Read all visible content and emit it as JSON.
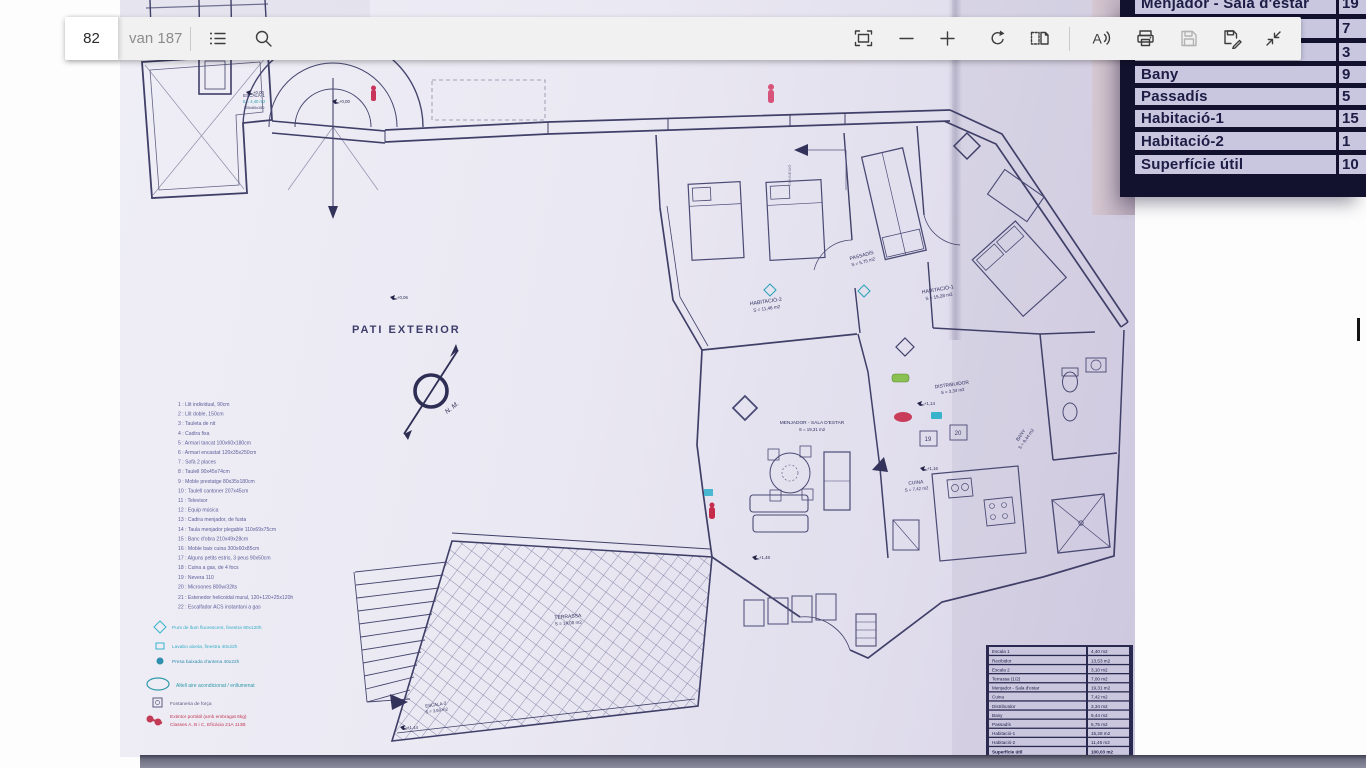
{
  "toolbar": {
    "page_input_value": "82",
    "of_label": "van 187",
    "buttons": [
      "contents",
      "search",
      "fit-to-page",
      "zoom-out",
      "zoom-in",
      "rotate",
      "page-layout",
      "read-aloud",
      "print",
      "save",
      "save-as",
      "exit-fullscreen"
    ]
  },
  "inset_table": {
    "rows": [
      {
        "label": "Menjador - Sala d'estar",
        "value": "19"
      },
      {
        "label": "",
        "value": "7"
      },
      {
        "label": "",
        "value": "3"
      },
      {
        "label": "Bany",
        "value": "9"
      },
      {
        "label": "Passadís",
        "value": "5"
      },
      {
        "label": "Habitació-1",
        "value": "15"
      },
      {
        "label": "Habitació-2",
        "value": "1"
      },
      {
        "label": "Superfície útil",
        "value": "10"
      }
    ]
  },
  "plan": {
    "pati_label": "PATI EXTERIOR",
    "compass_label": "N. M.",
    "connexio_label": "CONNEXIÓ",
    "kitchen_tags": [
      "19",
      "20"
    ],
    "levels": [
      "+0,00",
      "+0,06",
      "+1,14",
      "+1,16",
      "+1,44",
      "+1,48"
    ],
    "rooms": [
      {
        "name": "ESCALA-1",
        "area": "S = 4,40 m2",
        "extra": "100x60x150"
      },
      {
        "name": "HABITACIÓ-2",
        "area": "S = 11,46 m2"
      },
      {
        "name": "PASSADÍS",
        "area": "S = 5,75 m2"
      },
      {
        "name": "HABITACIÓ-1",
        "area": "S = 15,28 m2"
      },
      {
        "name": "DISTRIBUIDOR",
        "area": "S = 3,34 m2"
      },
      {
        "name": "MENJADOR - SALA D'ESTAR",
        "area": "S = 19,31 m2"
      },
      {
        "name": "BANY",
        "area": "S = 9,44 m2"
      },
      {
        "name": "CUINA",
        "area": "S = 7,42 m2"
      },
      {
        "name": "TERRASSA",
        "area": "S = 14,00 m2"
      },
      {
        "name": "ESCALA-2",
        "area": "S = 3,60 m2"
      }
    ],
    "legend": {
      "items": [
        "1 : Llit individual, 90cm",
        "2 : Llit doble, 150cm",
        "3 : Tauleta de nit",
        "4 : Cadira fixa",
        "5 : Armari tancat 100x60x180cm",
        "6 : Armari encastat 120x35x250cm",
        "7 : Sofà 2 places",
        "8 : Taulell 90x45x74cm",
        "9 : Moble prestatge 80x35x180cm",
        "10 : Taulell cantoner 207x45cm",
        "11 : Televisor",
        "12 : Equip música",
        "13 : Cadira menjador, de fusta",
        "14 : Taula menjador plegable 110x69x75cm",
        "15 : Banc d'obra 210x49x28cm",
        "16 : Moble baix cuina 300x60x85cm",
        "17 : Alguns petits estris, 3 peus 90x50cm",
        "18 : Cuina a gas, de 4 focs",
        "19 : Nevera 110",
        "20 : Microones 800w/32lts",
        "21 : Estenedor helicoidal mural, 120+120+25x120h",
        "22 : Escalfador ACS instantani a gas"
      ],
      "notes_cyan": [
        "Punt de llum fluorescent, finestra 90x120h",
        "Lavabo aixeta, finestra 40x22h",
        "Presa baixada d'antena 40x22h"
      ],
      "note_teal": "Altell aire acondicionat / enllumenat",
      "note_fontaneria": "Fontaneria de força",
      "note_red_line1": "Extintor portàtil (amb embragat 6kg)",
      "note_red_line2": "Classes A, B i C, Eficàcia 21A 113B"
    },
    "area_table": {
      "rows": [
        {
          "label": "Escala 1",
          "value": "4,40 m2"
        },
        {
          "label": "Recibidor",
          "value": "13,53 m2"
        },
        {
          "label": "Escala 2",
          "value": "3,10 m2"
        },
        {
          "label": "Terrassa (1/2)",
          "value": "7,00 m2"
        },
        {
          "label": "Menjador - Sala d'estar",
          "value": "19,31 m2"
        },
        {
          "label": "Cuina",
          "value": "7,42 m2"
        },
        {
          "label": "Distribuïdor",
          "value": "3,34 m2"
        },
        {
          "label": "Bany",
          "value": "9,44 m2"
        },
        {
          "label": "Passadís",
          "value": "5,75 m2"
        },
        {
          "label": "Habitació-1",
          "value": "15,28 m2"
        },
        {
          "label": "Habitació-2",
          "value": "11,46 m2"
        },
        {
          "label": "Superfície útil",
          "value": "100,03 m2"
        }
      ]
    },
    "colors": {
      "annotation_red": "#c62b4a",
      "annotation_cyan": "#39b3cc",
      "annotation_green": "#8abf52",
      "annotation_teal": "#2fa3b8",
      "legend_red": "#c23b55"
    }
  }
}
